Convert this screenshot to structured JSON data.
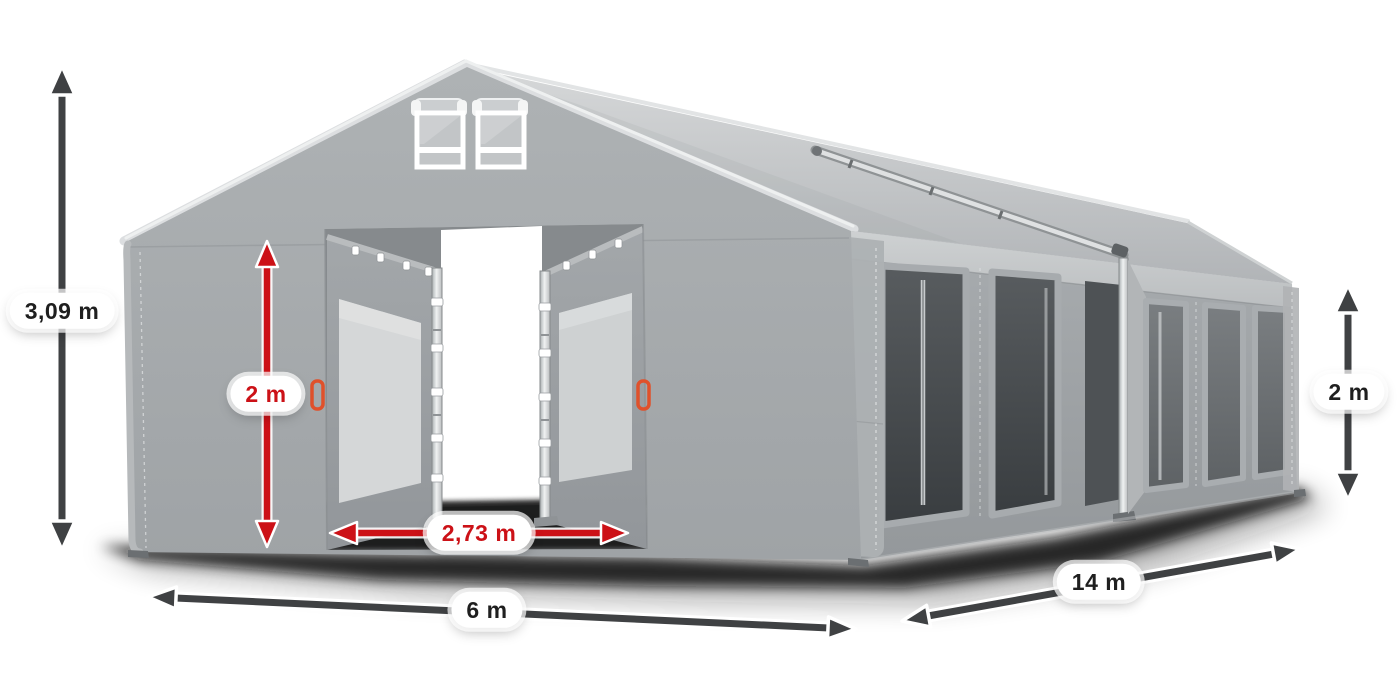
{
  "dimensions": {
    "total_height": "3,09 m",
    "door_height": "2 m",
    "door_width": "2,73 m",
    "front_width": "6 m",
    "side_length": "14 m",
    "side_height": "2 m"
  },
  "colors": {
    "background": "#ffffff",
    "dimension_red": "#cc1117",
    "dimension_dark": "#3f4143",
    "label_bg": "#ffffff",
    "label_text_dark": "#1f1f1f",
    "tent_fabric": "#a4a8ab",
    "tent_roof": "#c8cbcd",
    "tent_shadow": "#0a0a0a",
    "frame_metal": "#d9dbdc",
    "handle_orange": "#e0512b"
  },
  "icons": {
    "vertical_double_arrow": "double-headed vertical arrow",
    "horizontal_double_arrow": "double-headed horizontal arrow"
  }
}
